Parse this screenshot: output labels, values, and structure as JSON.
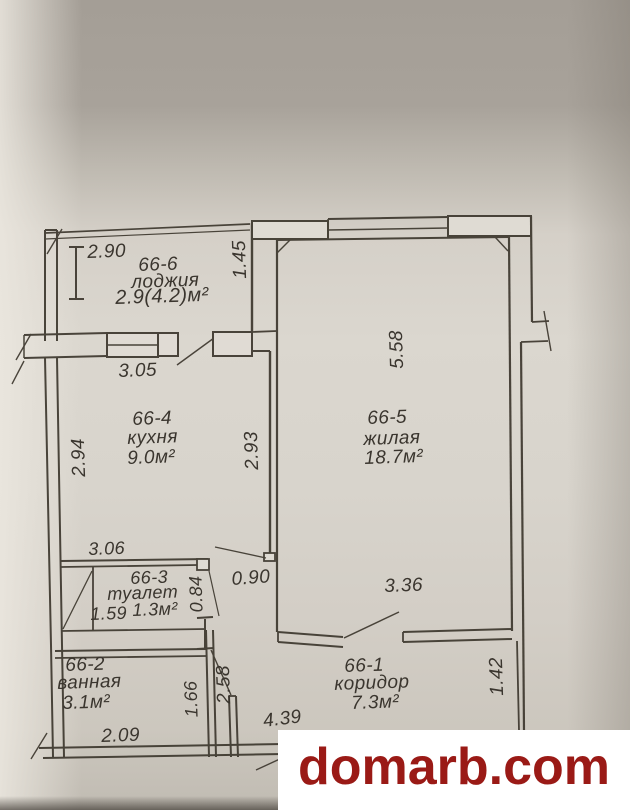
{
  "photo": {
    "watermark": "domarb.com",
    "watermark_color": "#9a1a16",
    "paper_color": "#d8d4cc",
    "line_color": "#3e382f"
  },
  "plan": {
    "rooms": [
      {
        "number": "66-6",
        "name": "лоджия",
        "area": "2.9(4.2)м²"
      },
      {
        "number": "66-4",
        "name": "кухня",
        "area": "9.0м²"
      },
      {
        "number": "66-5",
        "name": "жилая",
        "area": "18.7м²"
      },
      {
        "number": "66-3",
        "name": "туалет",
        "area": "1.3м²"
      },
      {
        "number": "66-2",
        "name": "ванная",
        "area": "3.1м²"
      },
      {
        "number": "66-1",
        "name": "коридор",
        "area": "7.3м²"
      }
    ],
    "dimensions": {
      "loggia_width": "2.90",
      "loggia_depth": "1.45",
      "kitchen_window_wall": "3.05",
      "kitchen_left": "2.94",
      "kitchen_right": "2.93",
      "living_depth": "5.58",
      "toilet_wall": "3.06",
      "toilet_depth": "0.84",
      "kitchen_door": "0.90",
      "living_bottom": "3.36",
      "toilet_width": "1.59",
      "bath_bottom": "2.09",
      "bath_right": "1.66",
      "corridor_left": "2.58",
      "corridor_bottom": "4.39",
      "corridor_right": "1.42"
    }
  }
}
